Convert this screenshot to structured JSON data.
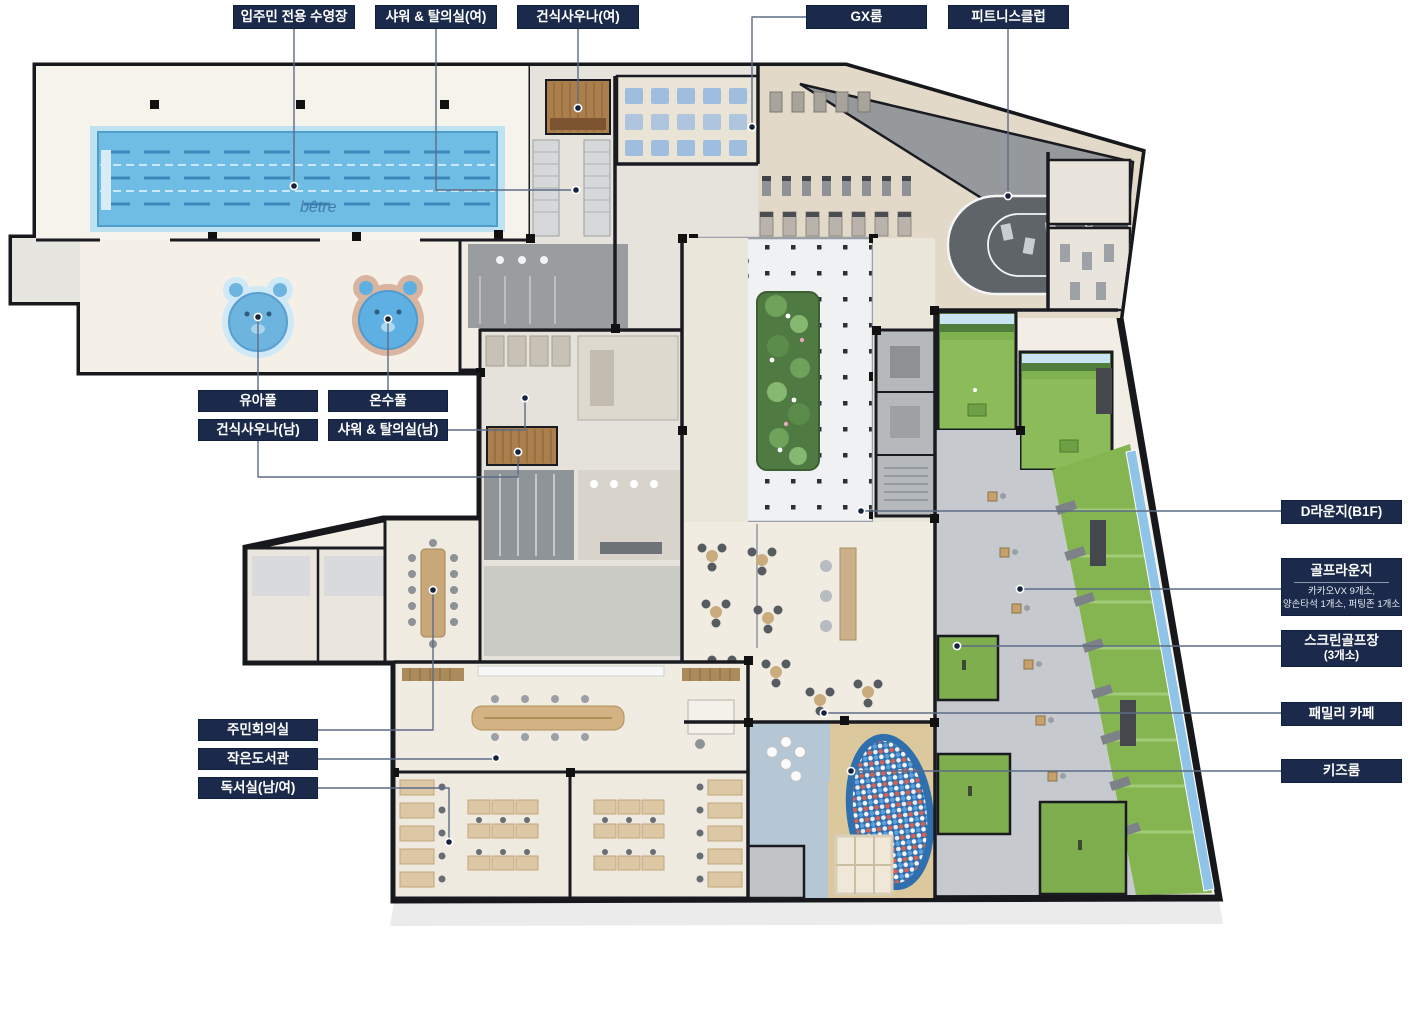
{
  "floorplan": {
    "pool_watermark": "bêtre",
    "colors": {
      "label_bg": "#1b2a4a",
      "label_text": "#ffffff",
      "leader_line": "#5d6c86",
      "wall": "#17181c",
      "pool_water": "#6fbce5",
      "turf_green": "#84b551",
      "track_gray": "#5f6469",
      "ballpit_blue": "#2f6fad",
      "floor_cream": "#f2eee6"
    },
    "callouts": [
      {
        "id": "resident-pool",
        "label": "입주민 전용 수영장",
        "box": {
          "x": 233,
          "y": 5,
          "w": 122,
          "h": 24
        },
        "line": [
          [
            294,
            29
          ],
          [
            294,
            186
          ]
        ],
        "dot": [
          294,
          186
        ]
      },
      {
        "id": "shower-women",
        "label": "샤워 & 탈의실(여)",
        "box": {
          "x": 375,
          "y": 5,
          "w": 122,
          "h": 24
        },
        "line": [
          [
            436,
            29
          ],
          [
            436,
            190
          ],
          [
            571,
            190
          ]
        ],
        "dot": [
          576,
          190
        ]
      },
      {
        "id": "dry-sauna-women",
        "label": "건식사우나(여)",
        "box": {
          "x": 517,
          "y": 5,
          "w": 122,
          "h": 24
        },
        "line": [
          [
            578,
            29
          ],
          [
            578,
            108
          ]
        ],
        "dot": [
          578,
          108
        ]
      },
      {
        "id": "gx-room",
        "label": "GX룸",
        "box": {
          "x": 806,
          "y": 5,
          "w": 121,
          "h": 24
        },
        "line": [
          [
            806,
            17
          ],
          [
            752,
            17
          ],
          [
            752,
            123
          ]
        ],
        "dot": [
          752,
          127
        ]
      },
      {
        "id": "fitness-club",
        "label": "피트니스클럽",
        "box": {
          "x": 948,
          "y": 5,
          "w": 121,
          "h": 24
        },
        "line": [
          [
            1008,
            29
          ],
          [
            1008,
            192
          ]
        ],
        "dot": [
          1008,
          196
        ]
      },
      {
        "id": "infant-pool",
        "label": "유아풀",
        "box": {
          "x": 198,
          "y": 390,
          "w": 120,
          "h": 22
        },
        "line": [
          [
            258,
            390
          ],
          [
            258,
            320
          ]
        ],
        "dot": [
          258,
          317
        ]
      },
      {
        "id": "warm-pool",
        "label": "온수풀",
        "box": {
          "x": 328,
          "y": 390,
          "w": 120,
          "h": 22
        },
        "line": [
          [
            388,
            390
          ],
          [
            388,
            322
          ]
        ],
        "dot": [
          388,
          319
        ]
      },
      {
        "id": "dry-sauna-men",
        "label": "건식사우나(남)",
        "box": {
          "x": 198,
          "y": 419,
          "w": 120,
          "h": 22
        },
        "line": [
          [
            258,
            441
          ],
          [
            258,
            477
          ],
          [
            518,
            477
          ],
          [
            518,
            456
          ]
        ],
        "dot": [
          518,
          452
        ]
      },
      {
        "id": "shower-men",
        "label": "샤워 & 탈의실(남)",
        "box": {
          "x": 328,
          "y": 419,
          "w": 120,
          "h": 22
        },
        "line": [
          [
            448,
            430
          ],
          [
            525,
            430
          ],
          [
            525,
            402
          ]
        ],
        "dot": [
          525,
          398
        ]
      },
      {
        "id": "d-lounge",
        "label": "D라운지(B1F)",
        "box": {
          "x": 1281,
          "y": 500,
          "w": 121,
          "h": 24
        },
        "line": [
          [
            1281,
            511
          ],
          [
            865,
            511
          ]
        ],
        "dot": [
          861,
          511
        ]
      },
      {
        "id": "golf-lounge",
        "label": "골프라운지",
        "divider": true,
        "sub": [
          "카카오VX 9개소,",
          "양손타석 1개소, 퍼팅존 1개소"
        ],
        "box": {
          "x": 1281,
          "y": 558,
          "w": 121,
          "h": 58
        },
        "line": [
          [
            1281,
            589
          ],
          [
            1024,
            589
          ]
        ],
        "dot": [
          1020,
          589
        ]
      },
      {
        "id": "screen-golf",
        "label": "스크린골프장",
        "cls": "big-sub",
        "sub": [
          "(3개소)"
        ],
        "box": {
          "x": 1281,
          "y": 630,
          "w": 121,
          "h": 37
        },
        "line": [
          [
            1281,
            646
          ],
          [
            961,
            646
          ]
        ],
        "dot": [
          957,
          646
        ]
      },
      {
        "id": "family-cafe",
        "label": "패밀리 카페",
        "box": {
          "x": 1281,
          "y": 702,
          "w": 121,
          "h": 24
        },
        "line": [
          [
            1281,
            713
          ],
          [
            828,
            713
          ]
        ],
        "dot": [
          824,
          713
        ]
      },
      {
        "id": "kids-room",
        "label": "키즈룸",
        "box": {
          "x": 1281,
          "y": 759,
          "w": 121,
          "h": 24
        },
        "line": [
          [
            1281,
            771
          ],
          [
            855,
            771
          ]
        ],
        "dot": [
          851,
          771
        ]
      },
      {
        "id": "meeting-room",
        "label": "주민회의실",
        "box": {
          "x": 198,
          "y": 719,
          "w": 120,
          "h": 22
        },
        "line": [
          [
            318,
            730
          ],
          [
            433,
            730
          ],
          [
            433,
            594
          ]
        ],
        "dot": [
          433,
          590
        ]
      },
      {
        "id": "small-library",
        "label": "작은도서관",
        "box": {
          "x": 198,
          "y": 748,
          "w": 120,
          "h": 22
        },
        "line": [
          [
            318,
            759
          ],
          [
            492,
            759
          ]
        ],
        "dot": [
          496,
          758
        ]
      },
      {
        "id": "reading-room",
        "label": "독서실(남/여)",
        "box": {
          "x": 198,
          "y": 777,
          "w": 120,
          "h": 22
        },
        "line": [
          [
            318,
            788
          ],
          [
            449,
            788
          ],
          [
            449,
            838
          ]
        ],
        "dot": [
          449,
          842
        ]
      }
    ]
  }
}
